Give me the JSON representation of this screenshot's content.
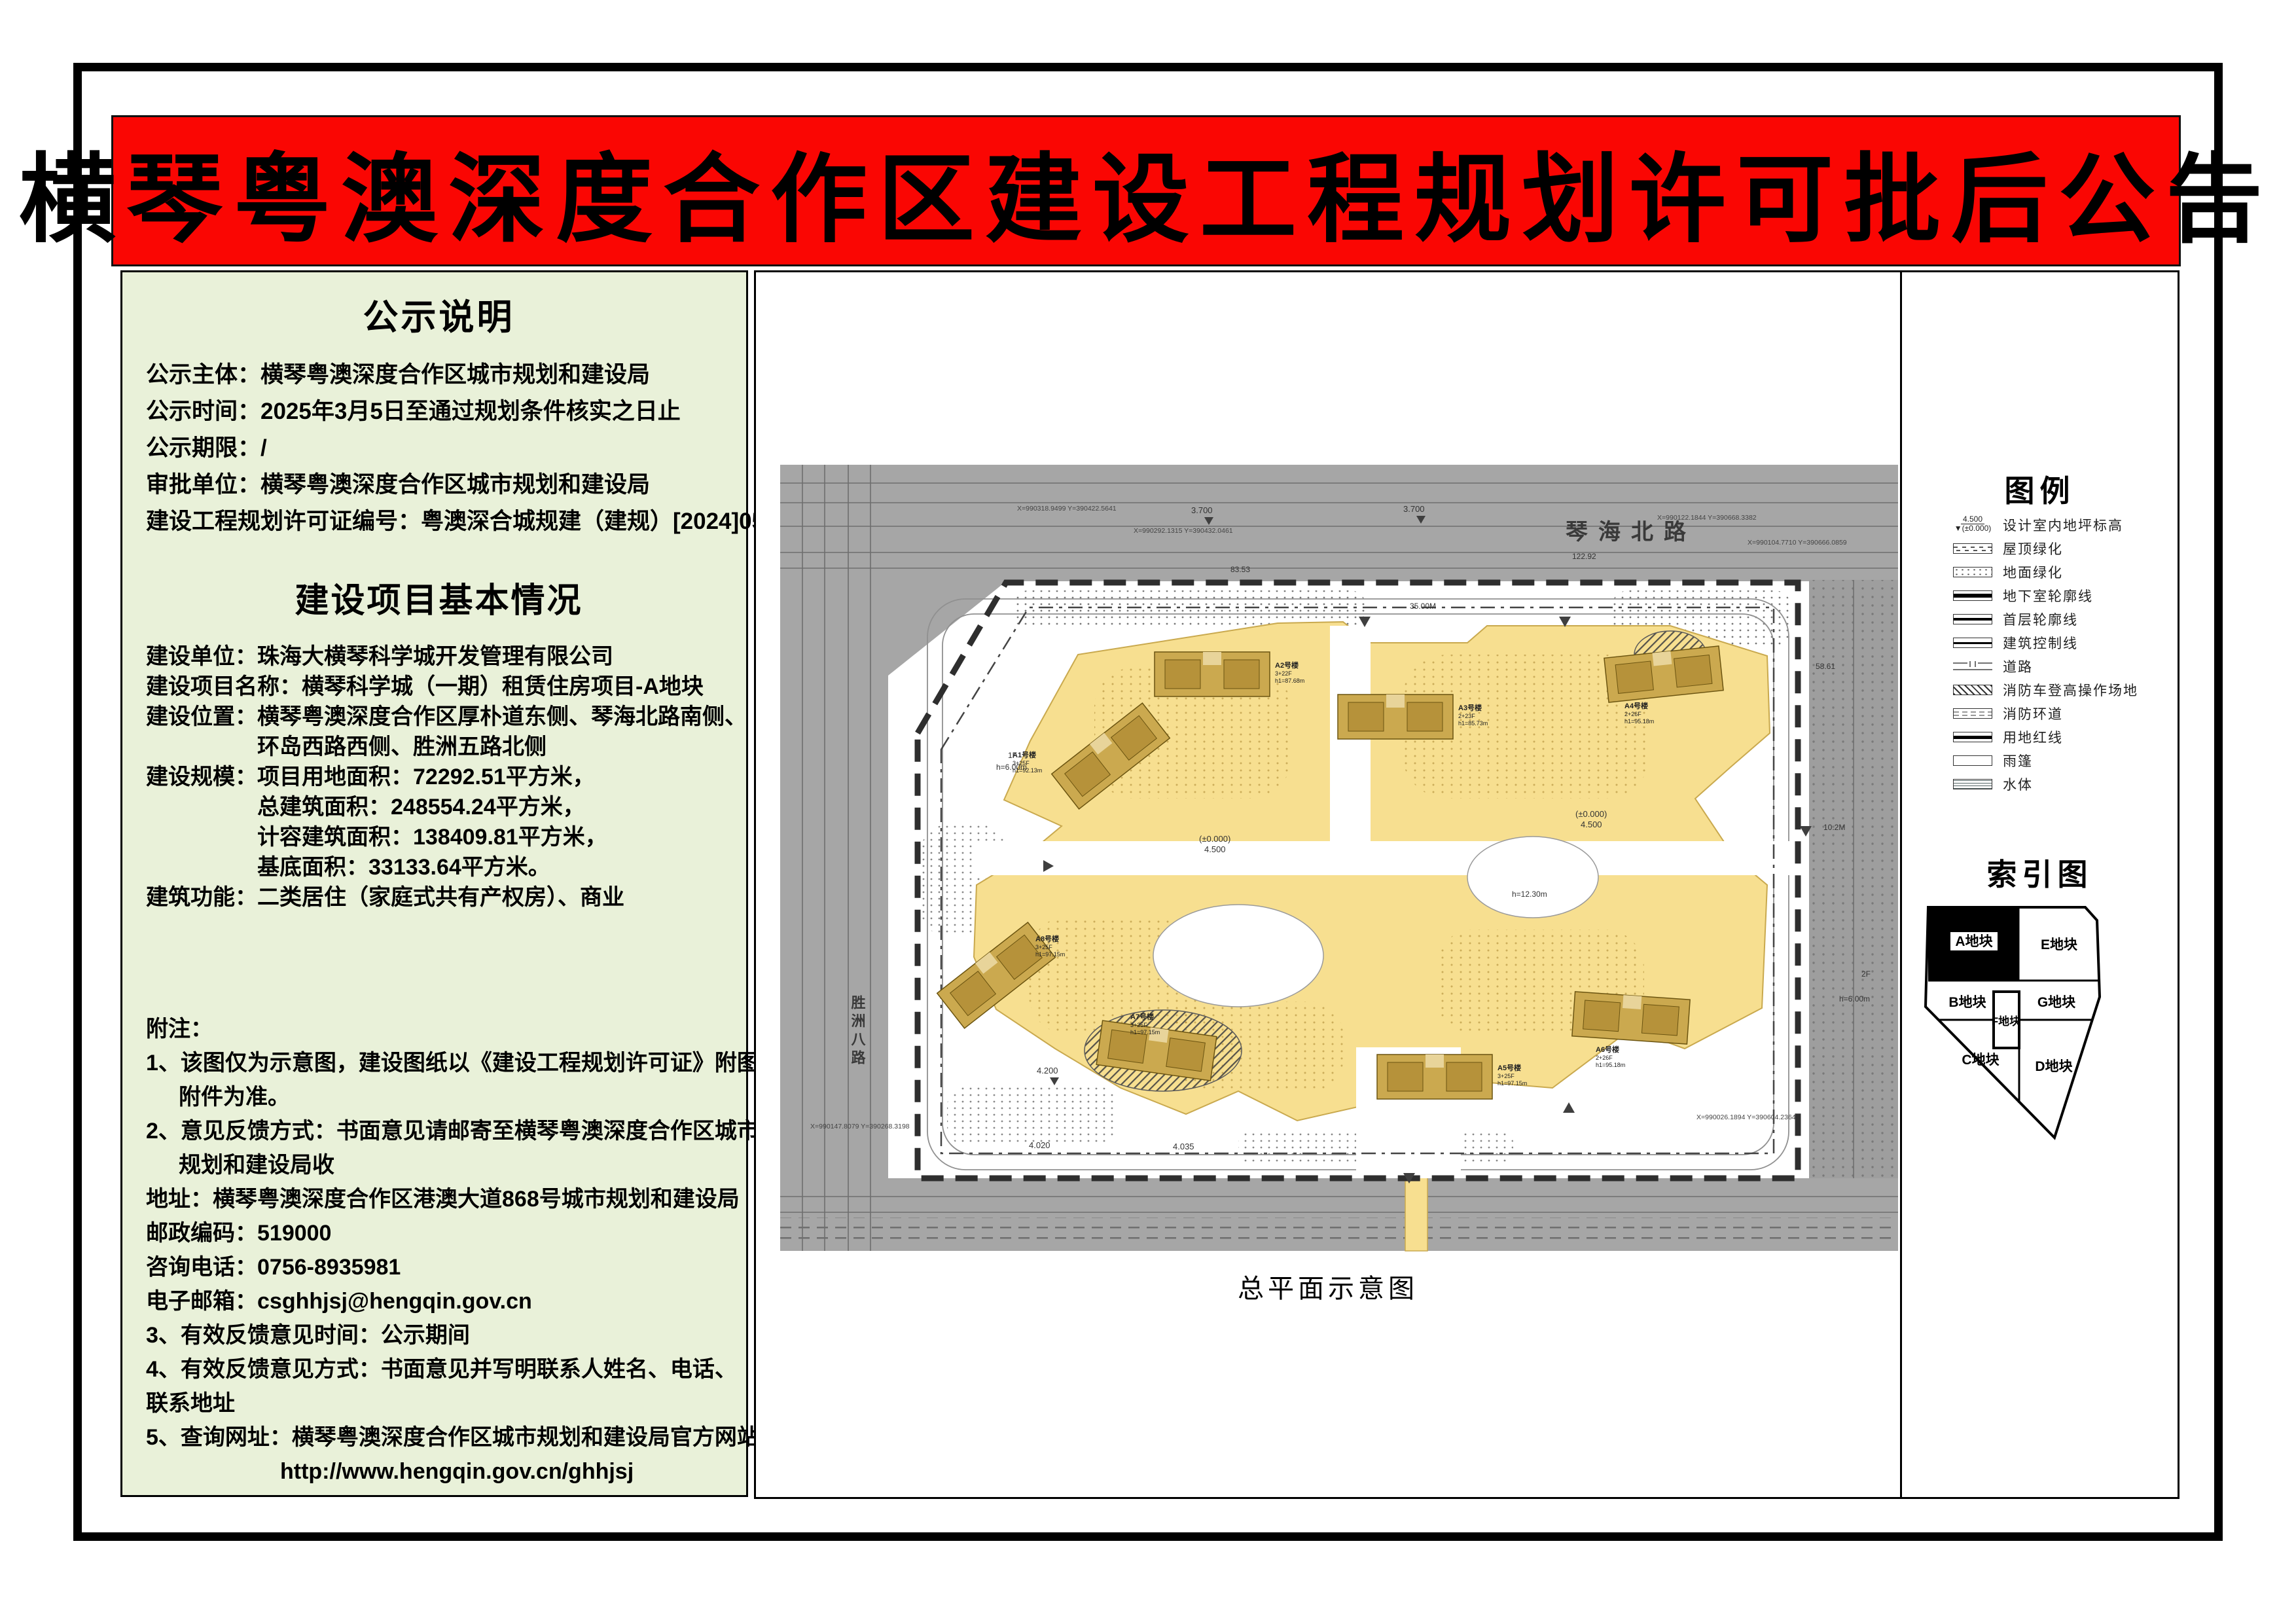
{
  "page": {
    "title": "横琴粤澳深度合作区建设工程规划许可批后公告"
  },
  "notice": {
    "title": "公示说明",
    "lines": [
      "公示主体：横琴粤澳深度合作区城市规划和建设局",
      "公示时间：2025年3月5日至通过规划条件核实之日止",
      "公示期限：/",
      "审批单位：横琴粤澳深度合作区城市规划和建设局",
      "建设工程规划许可证编号：粤澳深合城规建（建规）[2024]054号"
    ]
  },
  "project": {
    "title": "建设项目基本情况",
    "lines": [
      "建设单位：珠海大横琴科学城开发管理有限公司",
      "建设项目名称：横琴科学城（一期）租赁住房项目-A地块",
      "建设位置：横琴粤澳深度合作区厚朴道东侧、琴海北路南侧、",
      "环岛西路西侧、胜洲五路北侧",
      "建设规模：项目用地面积：72292.51平方米，",
      "总建筑面积：248554.24平方米，",
      "计容建筑面积：138409.81平方米，",
      "基底面积：33133.64平方米。",
      "建筑功能：二类居住（家庭式共有产权房）、商业"
    ]
  },
  "remarks": {
    "lines": [
      "附注：",
      "1、该图仅为示意图，建设图纸以《建设工程规划许可证》附图",
      "附件为准。",
      "2、意见反馈方式：书面意见请邮寄至横琴粤澳深度合作区城市",
      "规划和建设局收",
      "地址：横琴粤澳深度合作区港澳大道868号城市规划和建设局",
      "邮政编码：519000",
      "咨询电话：0756-8935981",
      "电子邮箱：csghhjsj@hengqin.gov.cn",
      "3、有效反馈意见时间：公示期间",
      "4、有效反馈意见方式：书面意见并写明联系人姓名、电话、",
      "联系地址",
      "5、查询网址：横琴粤澳深度合作区城市规划和建设局官方网站",
      "http://www.hengqin.gov.cn/ghhjsj"
    ]
  },
  "map": {
    "caption": "总平面示意图",
    "roads": {
      "north": "琴海北路",
      "west": "胜洲八路"
    },
    "elevations": {
      "e37": "3.700",
      "e42": "4.200",
      "e45": "4.500",
      "e00": "(±0.000)",
      "e402": "4.020",
      "e403": "4.035"
    },
    "dims": {
      "d0": "122.92",
      "d1": "83.53",
      "d2": "35.00M",
      "d3": "58.61"
    },
    "coords": [
      "X=990318.9499 Y=390422.5641",
      "X=990292.1315 Y=390432.0461",
      "X=990122.1844 Y=390668.3382",
      "X=990104.7710 Y=390666.0859",
      "X=990026.1894 Y=390604.2364",
      "X=990147.8079 Y=390268.3198"
    ],
    "parcel_labels": {
      "p0": "10.2M",
      "p1": "2F",
      "p2": "h=6.00m",
      "p3": "h=12.30m",
      "p4": "1F"
    },
    "buildings": [
      {
        "name": "A1号楼",
        "floors": "3+25F",
        "h1": "h1=92.13m",
        "h2": "h2=98.80m",
        "h3": "h3=107.85m"
      },
      {
        "name": "A2号楼",
        "floors": "3+22F",
        "h1": "h1=87.68m",
        "h2": "h2=89.10m",
        "h3": "h3=98.40m"
      },
      {
        "name": "A3号楼",
        "floors": "2+23F",
        "h1": "h1=85.73m",
        "h2": "h2=87.15m",
        "h3": "h3=96.45m"
      },
      {
        "name": "A4号楼",
        "floors": "2+26F",
        "h1": "h1=95.18m",
        "h2": "h2=96.40m",
        "h3": "h3=105.90m"
      },
      {
        "name": "A5号楼",
        "floors": "3+25F",
        "h1": "h1=97.15m",
        "h2": "h2=98.55m",
        "h3": "h3=107.85m"
      },
      {
        "name": "A6号楼",
        "floors": "2+26F",
        "h1": "h1=95.18m",
        "h2": "h2=96.40m",
        "h3": "h3=105.90m"
      },
      {
        "name": "A7号楼",
        "floors": "3+25F",
        "h1": "h1=97.15m",
        "h2": "h2=98.55m",
        "h3": "h3=107.85m"
      },
      {
        "name": "A8号楼",
        "floors": "3+25F",
        "h1": "h1=97.15m",
        "h2": "h2=98.55m",
        "h3": "h3=107.85m"
      }
    ]
  },
  "legend": {
    "title": "图例",
    "elev_top": "4.500",
    "elev_bottom": "▼(±0.000)",
    "items": [
      "设计室内地坪标高",
      "屋顶绿化",
      "地面绿化",
      "地下室轮廓线",
      "首层轮廓线",
      "建筑控制线",
      "道路",
      "消防车登高操作场地",
      "消防环道",
      "用地红线",
      "雨篷",
      "水体"
    ]
  },
  "index_map": {
    "title": "索引图",
    "plots": {
      "a": "A地块",
      "b": "B地块",
      "c": "C地块",
      "d": "D地块",
      "e": "E地块",
      "f": "F地块",
      "g": "G地块"
    }
  },
  "colors": {
    "banner_red": "#fa0603",
    "panel_green": "#e9f1d9",
    "site_yellow": "#f7df90",
    "building_tan": "#cba94f",
    "context_gray": "#a6a6a6"
  }
}
